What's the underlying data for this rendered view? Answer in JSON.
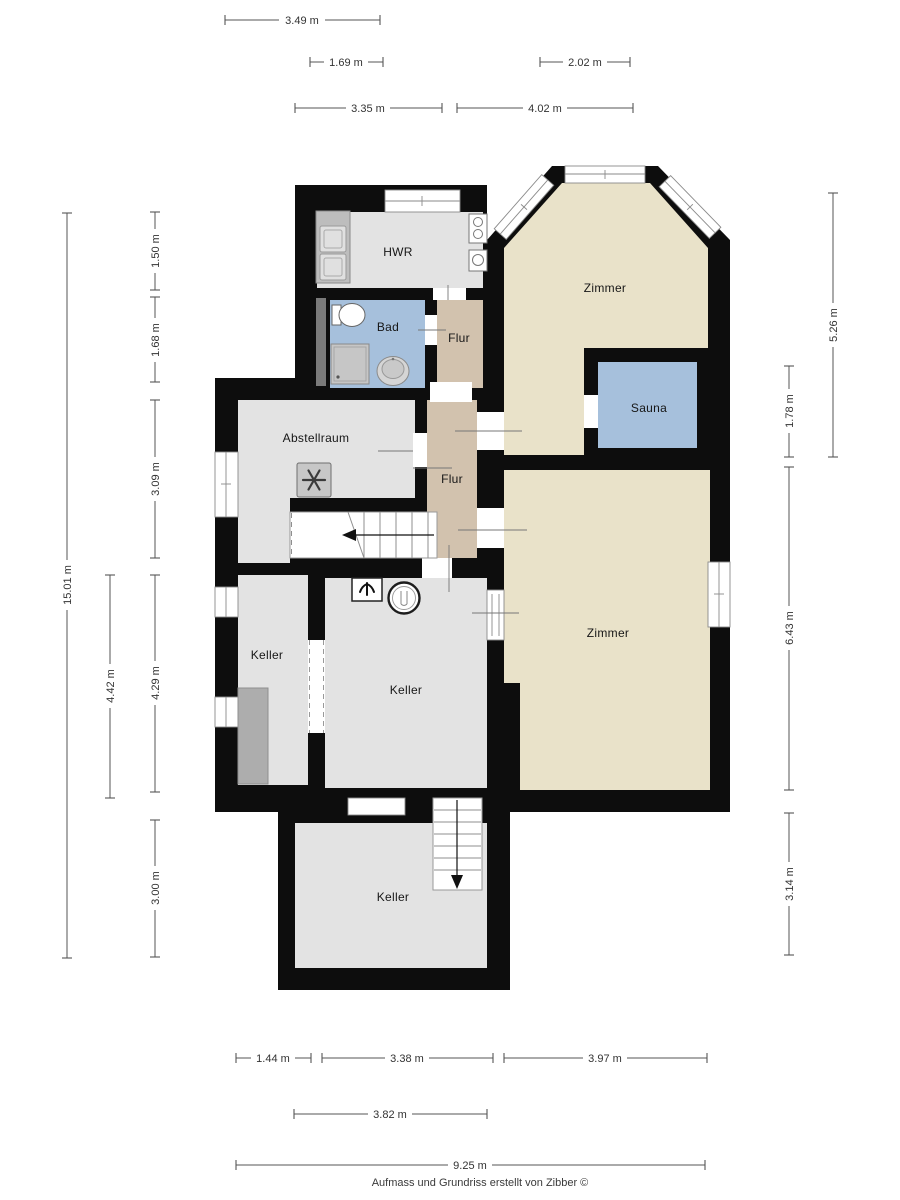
{
  "rooms": {
    "hwr": "HWR",
    "bad": "Bad",
    "flur_top": "Flur",
    "zimmer_top": "Zimmer",
    "sauna": "Sauna",
    "abstellraum": "Abstellraum",
    "flur_main": "Flur",
    "keller_left": "Keller",
    "keller_mid": "Keller",
    "zimmer_bottom": "Zimmer",
    "keller_bottom": "Keller"
  },
  "dimensions": {
    "top": [
      "3.49 m",
      "1.69 m",
      "2.02 m",
      "3.35 m",
      "4.02 m"
    ],
    "left": [
      "15.01 m",
      "1.50 m",
      "1.68 m",
      "3.09 m",
      "4.42 m",
      "4.29 m",
      "3.00 m"
    ],
    "right": [
      "5.26 m",
      "1.78 m",
      "6.43 m",
      "3.14 m"
    ],
    "bottom": [
      "1.44 m",
      "3.38 m",
      "3.97 m",
      "3.82 m",
      "9.25 m"
    ]
  },
  "footer": "Aufmass und Grundriss erstellt von Zibber ©",
  "icons": {
    "freezer": "snowflake-icon",
    "tap": "tap-icon",
    "boiler": "boiler-icon",
    "stairs_up": "arrow-left-icon",
    "stairs_down": "arrow-down-icon"
  },
  "colors": {
    "wall": "#0d0d0d",
    "room_gray": "#e3e3e3",
    "room_beige": "#e9e2c9",
    "room_blue": "#a6c0dc",
    "room_tan": "#d2c2ae",
    "fixture_gray": "#c9c9c9",
    "dimension_line": "#555555",
    "label_text": "#161616"
  }
}
